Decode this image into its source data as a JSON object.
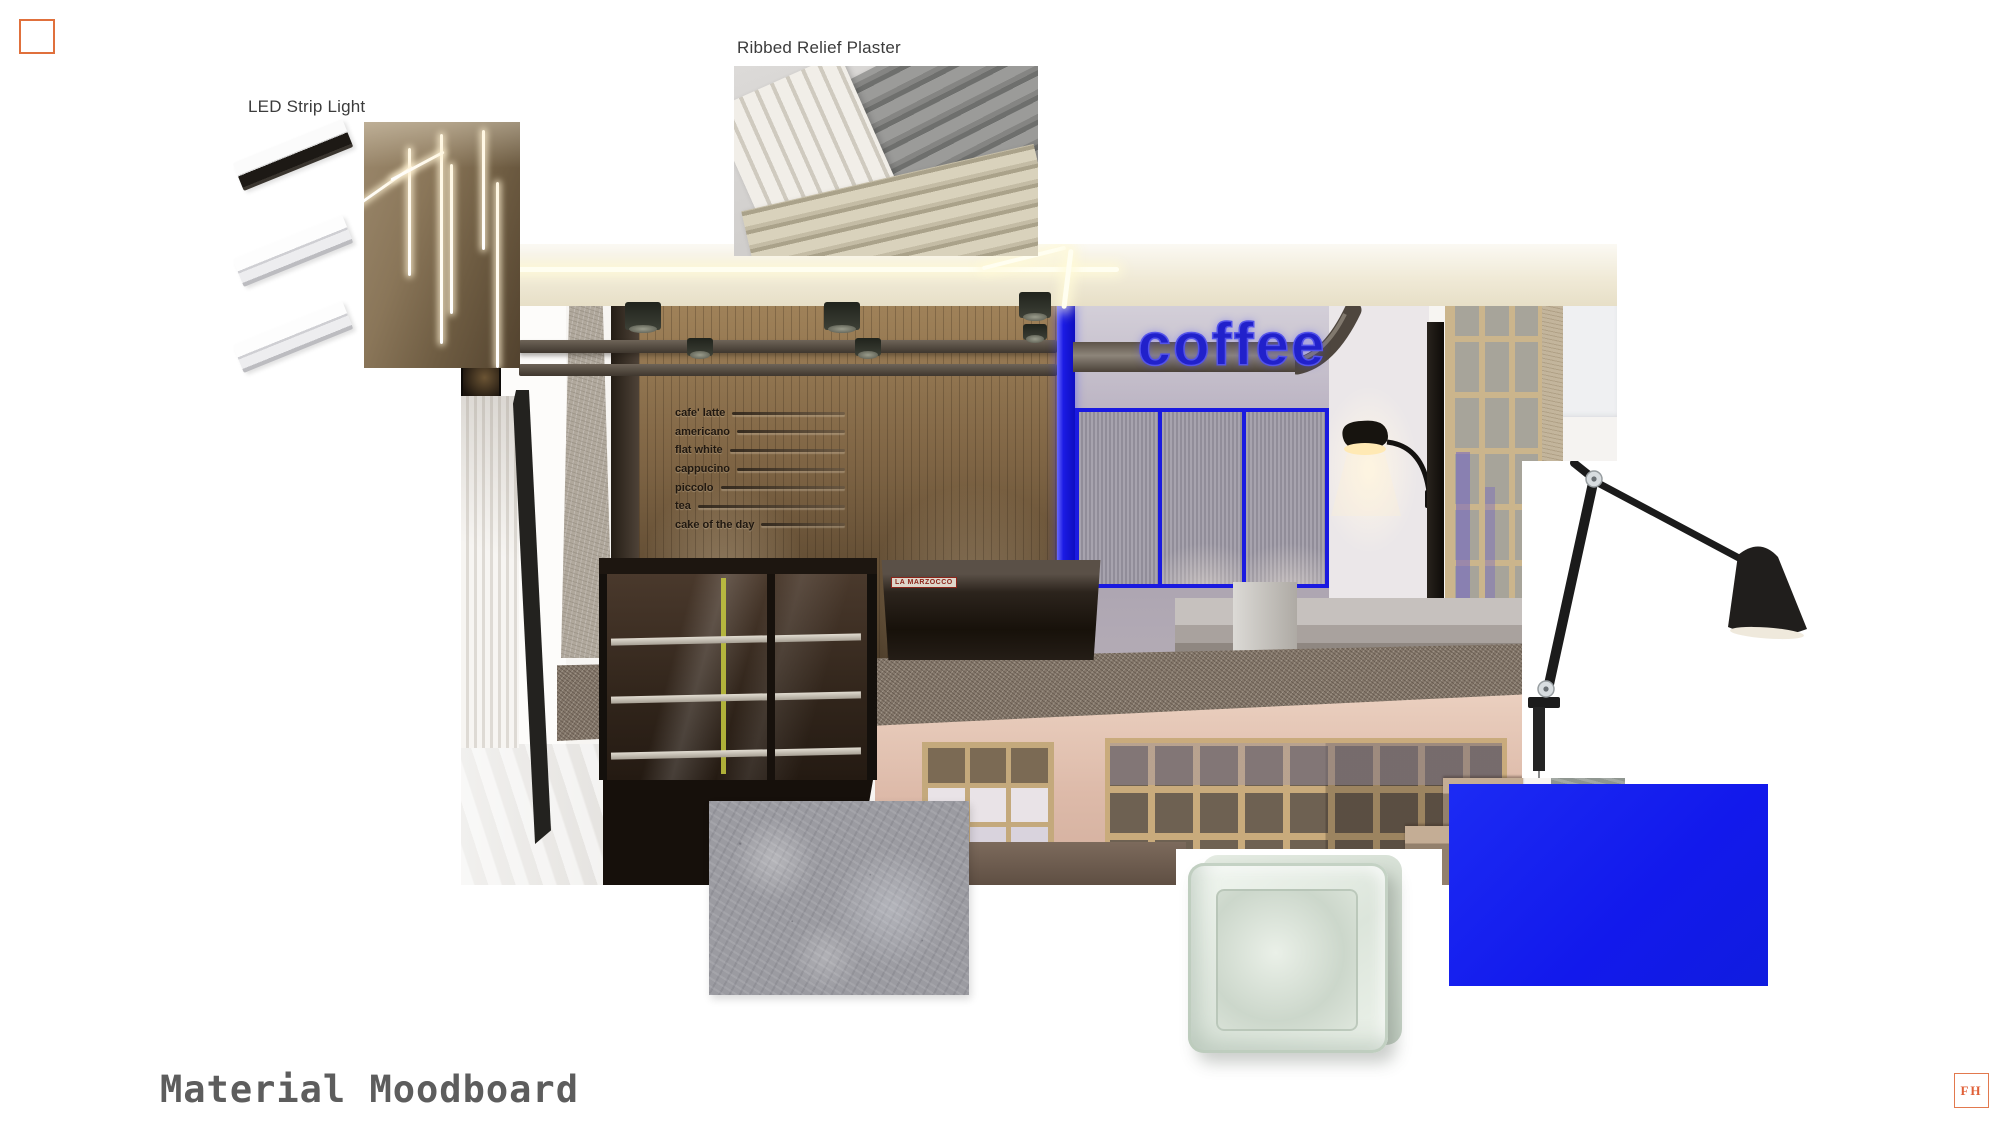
{
  "page": {
    "title": "Material Moodboard",
    "background": "#ffffff"
  },
  "accents": {
    "orange": "#e0703c",
    "swatch_blue": "#1420ee",
    "neon_blue": "#2121cb"
  },
  "materials": {
    "led": {
      "label": "LED Strip Light"
    },
    "plaster": {
      "label": "Ribbed Relief Plaster"
    }
  },
  "render": {
    "sign": "coffee",
    "machine_brand": "LA MARZOCCO",
    "menu": {
      "items": [
        "cafe' latte",
        "americano",
        "flat white",
        "cappucino",
        "piccolo",
        "tea",
        "cake of the day"
      ]
    }
  },
  "footer": {
    "title": "Material Moodboard",
    "logo": "FH"
  }
}
